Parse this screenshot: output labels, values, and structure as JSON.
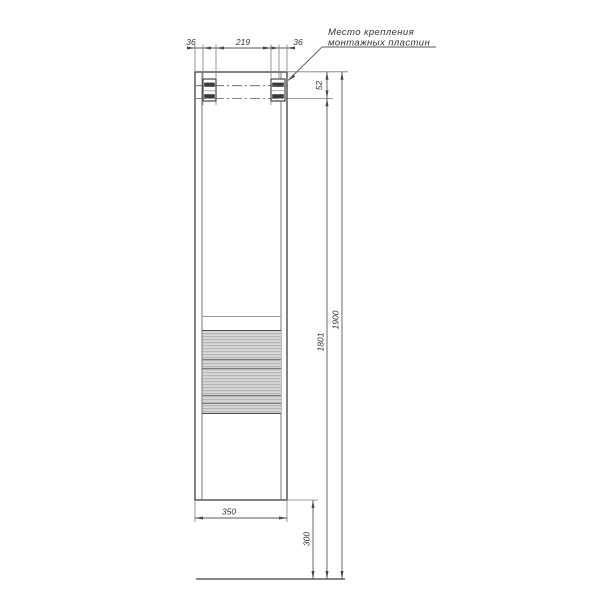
{
  "drawing": {
    "type": "furniture-mounting-dimension-drawing",
    "callout": {
      "line1": "Место крепления",
      "line2": "монтажных пластин"
    },
    "dimensions": {
      "top_left_offset": "36",
      "top_center_span": "219",
      "top_right_offset": "36",
      "plate_offset_from_top": "52",
      "plate_line_to_floor": "1801",
      "total_height": "1900",
      "cabinet_width": "350",
      "bottom_clearance": "300"
    },
    "colors": {
      "line": "#3f3f3f",
      "dimension_line": "#5a5a5a",
      "text": "#333333",
      "band_fill": "#d8d8d8",
      "band_stripe": "#ababab",
      "background": "#ffffff"
    }
  }
}
